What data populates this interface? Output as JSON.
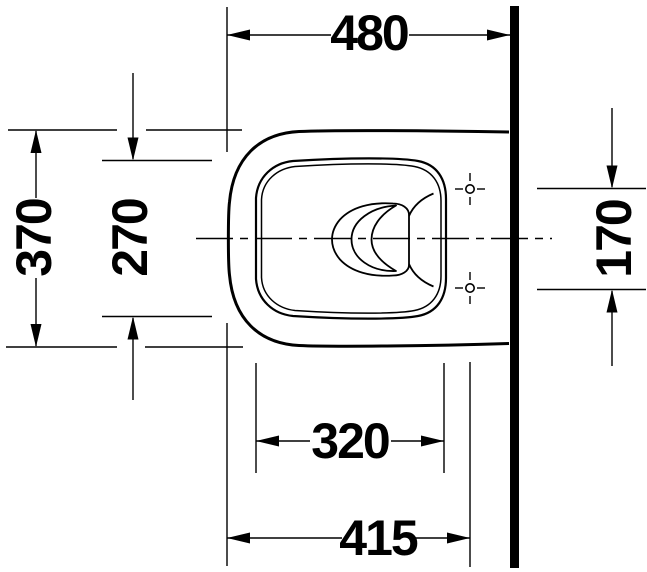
{
  "drawing": {
    "description": "technical plan-view drawing of a wall-hung toilet with installation dimensions",
    "background_color": "#ffffff",
    "line_color": "#000000",
    "dimensions": {
      "overall_depth": "480",
      "overall_width": "370",
      "bowl_inner_width": "270",
      "fixing_holes_spacing": "170",
      "bowl_inner_length": "320",
      "front_to_fixing_holes": "415"
    }
  }
}
